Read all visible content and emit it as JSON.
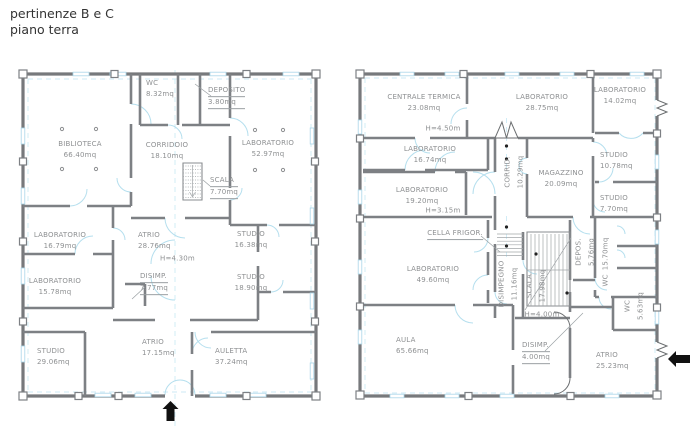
{
  "title": {
    "line1": "pertinenze B e C",
    "line2": "piano terra"
  },
  "colors": {
    "wall": "#7d8084",
    "label_text": "#8e9092",
    "accent_cyan": "#b5dfee",
    "arrow_black": "#111111"
  },
  "icons": {
    "left_entrance": "arrow-up",
    "right_entrance": "arrow-left"
  },
  "plans": {
    "left": {
      "rooms": [
        {
          "name": "WC",
          "area": "8.32mq"
        },
        {
          "name": "DEPOSITO",
          "area": "3.80mq"
        },
        {
          "name": "BIBLIOTECA",
          "area": "66.40mq"
        },
        {
          "name": "CORRIDOIO",
          "area": "18.10mq"
        },
        {
          "name": "LABORATORIO",
          "area": "52.97mq"
        },
        {
          "name": "SCALA",
          "area": "7.70mq"
        },
        {
          "name": "LABORATORIO",
          "area": "16.79mq"
        },
        {
          "name": "ATRIO",
          "area": "28.76mq",
          "height": "H=4.30m"
        },
        {
          "name": "STUDIO",
          "area": "16.38mq"
        },
        {
          "name": "DISIMP.",
          "area": "7.77mq"
        },
        {
          "name": "LABORATORIO",
          "area": "15.78mq"
        },
        {
          "name": "STUDIO",
          "area": "18.90mq"
        },
        {
          "name": "STUDIO",
          "area": "29.06mq"
        },
        {
          "name": "ATRIO",
          "area": "17.15mq"
        },
        {
          "name": "AULETTA",
          "area": "37.24mq"
        }
      ]
    },
    "right": {
      "rooms": [
        {
          "name": "CENTRALE  TERMICA",
          "area": "23.08mq",
          "height": "H=4.50m"
        },
        {
          "name": "LABORATORIO",
          "area": "28.75mq"
        },
        {
          "name": "LABORATORIO",
          "area": "14.02mq"
        },
        {
          "name": "LABORATORIO",
          "area": "16.74mq"
        },
        {
          "name": "CORRID.",
          "area": "10.29mq"
        },
        {
          "name": "MAGAZZINO",
          "area": "20.09mq"
        },
        {
          "name": "STUDIO",
          "area": "10.78mq"
        },
        {
          "name": "LABORATORIO",
          "area": "19.20mq",
          "height": "H=3.15m"
        },
        {
          "name": "STUDIO",
          "area": "7.70mq"
        },
        {
          "name": "CELLA  FRIGOR.",
          "area": ""
        },
        {
          "name": "LABORATORIO",
          "area": "49.60mq"
        },
        {
          "name": "DISIMPEGNO",
          "area": "11.16mq"
        },
        {
          "name": "SCALA",
          "area": "17.98mq",
          "height": "H=4.00m"
        },
        {
          "name": "DEPOS.",
          "area": "5.76mq"
        },
        {
          "name": "WC",
          "area": "15.70mq"
        },
        {
          "name": "WC",
          "area": "5.63mq"
        },
        {
          "name": "AULA",
          "area": "65.66mq"
        },
        {
          "name": "DISIMP.",
          "area": "4.00mq"
        },
        {
          "name": "ATRIO",
          "area": "25.23mq"
        }
      ]
    }
  }
}
